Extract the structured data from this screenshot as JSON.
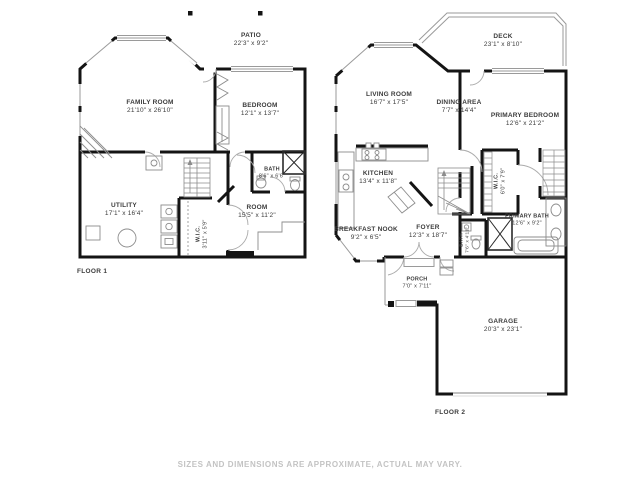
{
  "page": {
    "background": "#ffffff"
  },
  "colors": {
    "wall": "#141414",
    "thin_line": "#8c8c8c",
    "label_text": "#3c3c3c",
    "footer_text": "#c3c3c3"
  },
  "footer": {
    "disclaimer": "SIZES AND DIMENSIONS ARE APPROXIMATE, ACTUAL MAY VARY."
  },
  "floor1": {
    "label": "FLOOR 1",
    "rooms": {
      "patio": {
        "name": "PATIO",
        "dims": "22'3\" x 9'2\""
      },
      "family_room": {
        "name": "FAMILY ROOM",
        "dims": "21'10\" x 26'10\""
      },
      "bedroom": {
        "name": "BEDROOM",
        "dims": "12'1\" x 13'7\""
      },
      "bath": {
        "name": "BATH",
        "dims": "8'6\" x 6'6\""
      },
      "utility": {
        "name": "UTILITY",
        "dims": "17'1\" x 16'4\""
      },
      "room": {
        "name": "ROOM",
        "dims": "15'5\" x 11'2\""
      },
      "wic": {
        "name": "W.I.C.",
        "dims": "3'11\" x 5'9\""
      }
    }
  },
  "floor2": {
    "label": "FLOOR 2",
    "rooms": {
      "deck": {
        "name": "DECK",
        "dims": "23'1\" x 8'10\""
      },
      "living_room": {
        "name": "LIVING ROOM",
        "dims": "16'7\" x 17'5\""
      },
      "dining_area": {
        "name": "DINING AREA",
        "dims": "7'7\" x 14'4\""
      },
      "primary_bedroom": {
        "name": "PRIMARY BEDROOM",
        "dims": "12'6\" x 21'2\""
      },
      "kitchen": {
        "name": "KITCHEN",
        "dims": "13'4\" x 11'8\""
      },
      "breakfast_nook": {
        "name": "BREAKFAST NOOK",
        "dims": "9'2\" x 6'5\""
      },
      "foyer": {
        "name": "FOYER",
        "dims": "12'3\" x 18'7\""
      },
      "wic": {
        "name": "W.I.C.",
        "dims": "6'0\" x 7'9\""
      },
      "bath": {
        "name": "BATH",
        "dims": "7'6\" x 4'11\""
      },
      "primary_bath": {
        "name": "PRIMARY BATH",
        "dims": "12'6\" x 9'2\""
      },
      "porch": {
        "name": "PORCH",
        "dims": "7'0\" x 7'11\""
      },
      "garage": {
        "name": "GARAGE",
        "dims": "20'3\" x 23'1\""
      }
    }
  }
}
